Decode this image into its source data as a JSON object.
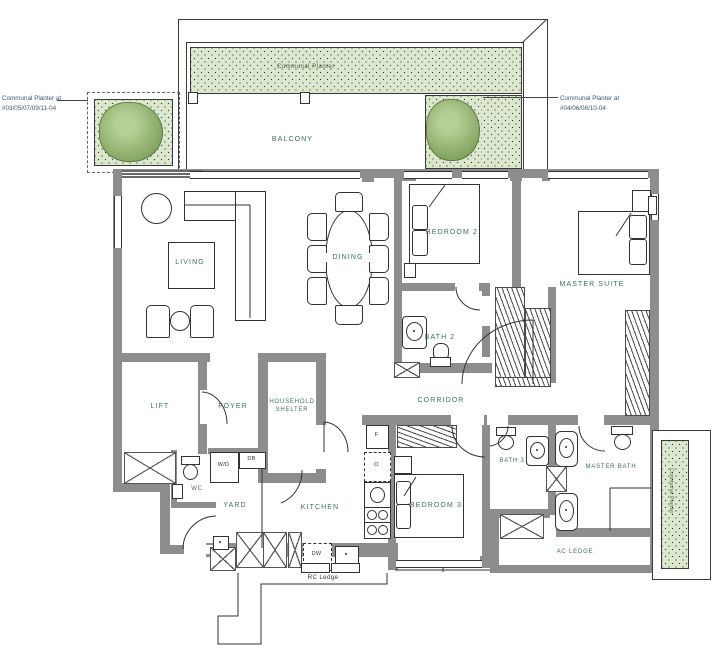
{
  "annotations": {
    "left_note": "Communal Planter at\n#03/05/07/09/11-04",
    "right_note": "Communal Planter at\n#04/06/08/10-04",
    "top_planter": "Communal Planter",
    "side_planter": "Communal Planter",
    "rc_ledge": "RC Ledge"
  },
  "rooms": {
    "balcony": "BALCONY",
    "living": "LIVING",
    "dining": "DINING",
    "bedroom2": "BEDROOM 2",
    "master_suite": "MASTER SUITE",
    "bath2": "BATH 2",
    "corridor": "CORRIDOR",
    "lift": "LIFT",
    "foyer": "FOYER",
    "household_shelter": "HOUSEHOLD\nSHELTER",
    "wc": "WC",
    "yard": "YARD",
    "kitchen": "KITCHEN",
    "bedroom3": "BEDROOM 3",
    "bath3": "BATH 3",
    "master_bath": "MASTER BATH",
    "ac_ledge": "AC LEDGE"
  },
  "appliances": {
    "washer_dryer": "W/D",
    "distribution_board": "DB",
    "fridge": "F",
    "oven": "O",
    "dishwasher": "DW"
  },
  "colors": {
    "wall": "#8d8d8d",
    "planter_fill": "#dce8cd",
    "tree": "#8fb26d",
    "label": "#3f6e66",
    "line": "#3a3a3a"
  }
}
